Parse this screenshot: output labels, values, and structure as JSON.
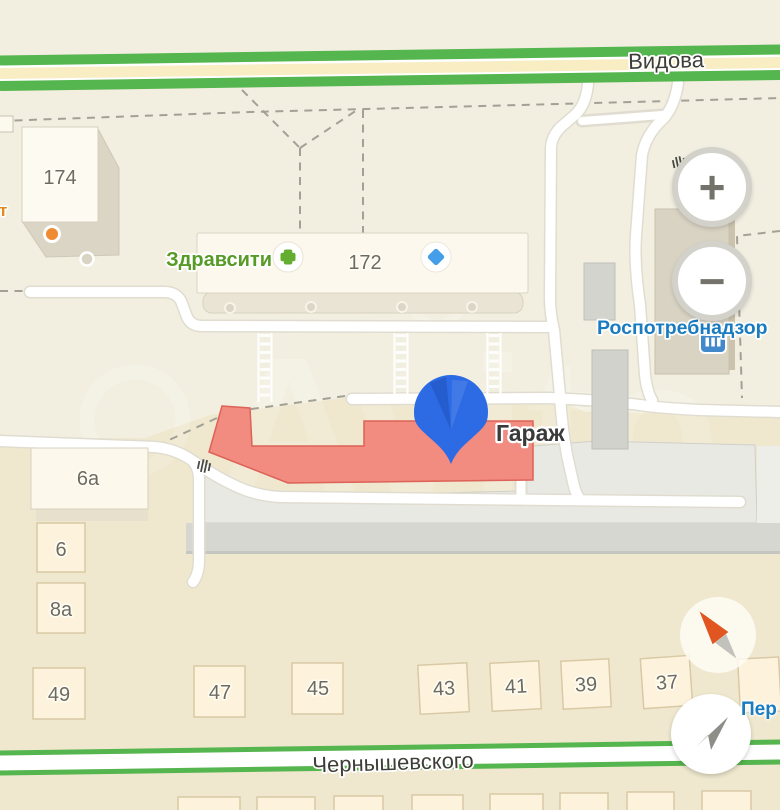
{
  "map": {
    "watermark": "Avito",
    "streets": {
      "vidova": "Видова",
      "chernyshevskogo": "Чернышевского",
      "per_cut": "Пер"
    },
    "pois": {
      "zdravsiti": "Здравсити",
      "rospotrebnadzor": "Роспотребнадзор",
      "garage": "Гараж",
      "cut_label_left": "т"
    },
    "buildings": {
      "b174": "174",
      "b172": "172",
      "b6a": "6а",
      "b6": "6",
      "b8a": "8а",
      "b49": "49",
      "b47": "47",
      "b45": "45",
      "b43": "43",
      "b41": "41",
      "b39": "39",
      "b37": "37"
    }
  },
  "controls": {
    "zoom_in": "+",
    "zoom_out": "−"
  },
  "colors": {
    "road_green": "#55b54e",
    "road_center_yellow": "#f8edc3",
    "selected_building": "#f28b80",
    "pin_blue": "#2c6be4",
    "poi_label_blue": "#1a7cc0",
    "pharmacy_green": "#579b26"
  }
}
